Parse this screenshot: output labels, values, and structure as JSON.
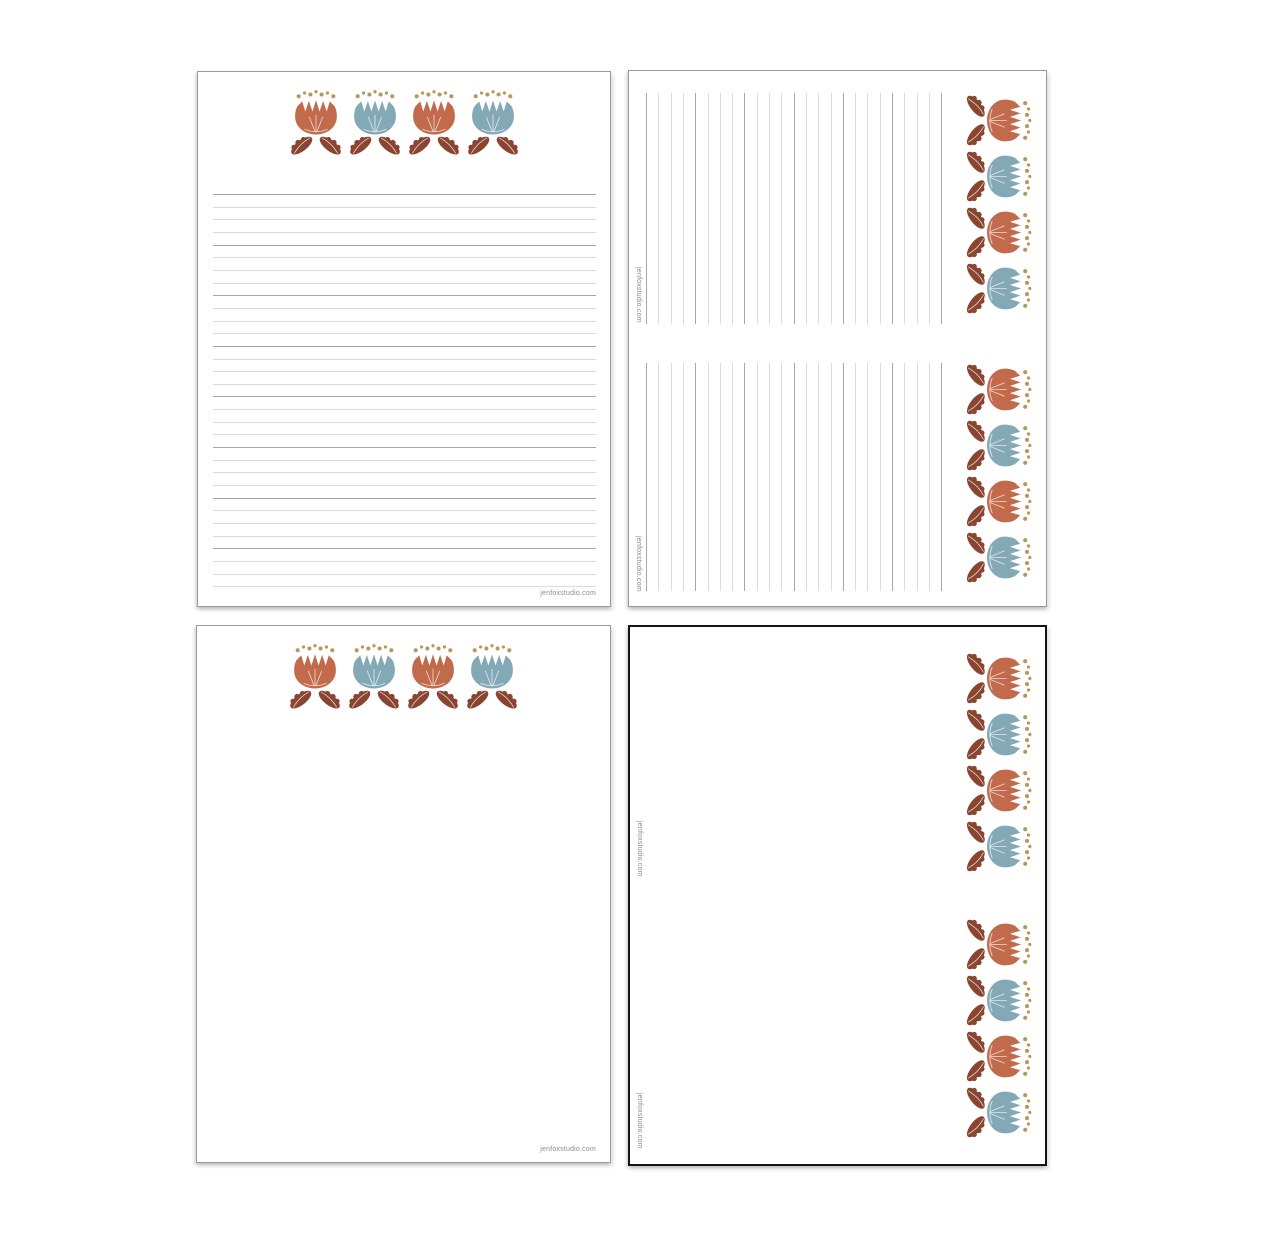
{
  "palette": {
    "flower_orange": "#C26B4C",
    "flower_blue": "#84A9B6",
    "leaf_brown": "#8A4531",
    "stamen_gold": "#B5985A",
    "line_light": "#DBDBDB",
    "line_dark": "#A6A6A6",
    "page_border_gray": "#999999",
    "page_border_black": "#141414",
    "footer_text_gray": "#8C8C8C",
    "page_background": "#FFFFFF"
  },
  "flower_motif": {
    "sequence": [
      "flower_orange",
      "flower_blue",
      "flower_orange",
      "flower_blue"
    ],
    "flowers_per_border": 4,
    "leaf_color_key": "leaf_brown",
    "stamen_color_key": "stamen_gold",
    "stamen_dots_per_flower": 7
  },
  "pages": [
    {
      "name": "lined-note-paper-portrait",
      "footer": "jenfoxstudio.com",
      "ruling": {
        "orientation": "horizontal",
        "line_count": 32,
        "emphasis_every": 4
      }
    },
    {
      "name": "lined-half-sheets-rotated-2up",
      "halves": [
        {
          "footer": "jenfoxstudio.com",
          "ruling": {
            "orientation": "vertical",
            "line_count": 25,
            "emphasis_every": 4
          }
        },
        {
          "footer": "jenfoxstudio.com",
          "ruling": {
            "orientation": "vertical",
            "line_count": 25,
            "emphasis_every": 4
          }
        }
      ]
    },
    {
      "name": "blank-note-paper-portrait",
      "footer": "jenfoxstudio.com"
    },
    {
      "name": "blank-half-sheets-rotated-2up",
      "halves": [
        {
          "footer": "jenfoxstudio.com"
        },
        {
          "footer": "jenfoxstudio.com"
        }
      ]
    }
  ]
}
